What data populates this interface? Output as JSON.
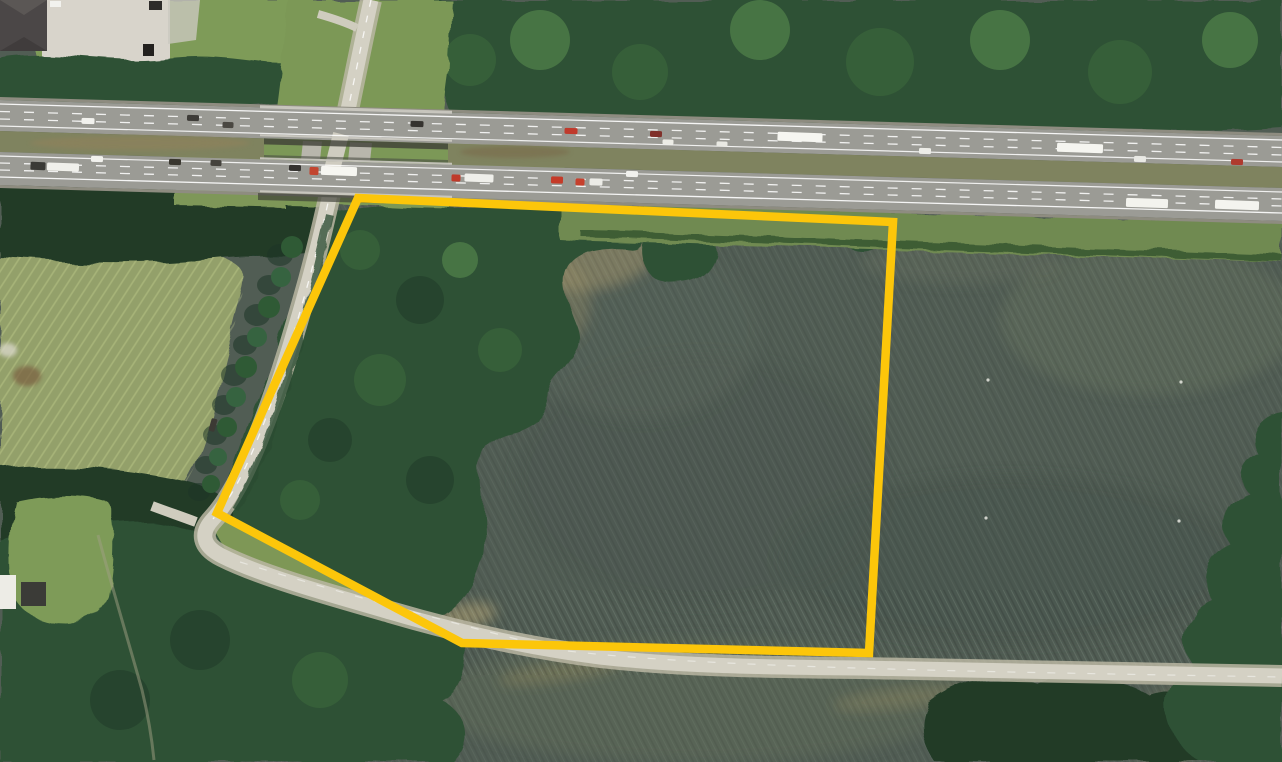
{
  "scene": {
    "type": "satellite-aerial-photo",
    "description": "Oblique aerial/satellite view of a land parcel outlined in yellow, bounded on the north by a divided interstate highway with an overpass interchange, on the west by a tree-lined local road descending from the overpass, and on the south by a rural road. Western half of the parcel is woodland, eastern half is open farm field. Surrounding farm fields, woods, a meadow, and a commercial building with parking lot at top left.",
    "visible_text": ""
  },
  "overlay": {
    "parcel_boundary": {
      "points": "358,198 893,222 869,653 462,643 217,513",
      "stroke_color": "#FCC60A",
      "stroke_width": 8.5
    }
  },
  "palette": {
    "field_dark": "#515D54",
    "field_mid": "#5A665A",
    "field_bottom": "#5D6857",
    "field_tan": "#A79A72",
    "meadow": "#93A06B",
    "lawn": "#7E9B58",
    "grass_verge": "#6F8A51",
    "embankment": "#7C9857",
    "tree_dark": "#203A28",
    "tree_mid": "#2E5134",
    "tree_light": "#3E6C3C",
    "tree_bright": "#5C9150",
    "scrub": "#33522F",
    "asphalt": "#9B9B95",
    "shoulder_gravel": "#8E8C80",
    "bridge_concrete": "#CDCBC3",
    "median_olive": "#7F835F",
    "median_brown": "#8F815C",
    "local_road": "#D4D1C4",
    "road_shoulder": "#BAB6A2",
    "parking": "#D8D4CB",
    "roof_dark": "#4B4747",
    "underpass_shadow": "#3E4037",
    "lane_marking": "#FFFFFF"
  },
  "vehicles": [
    {
      "cx": 88,
      "cy": 121,
      "w": 13,
      "h": 6,
      "fill": "#F2F2EE",
      "kind": "car"
    },
    {
      "cx": 193,
      "cy": 118,
      "w": 12,
      "h": 6,
      "fill": "#3E3C38",
      "kind": "car"
    },
    {
      "cx": 228,
      "cy": 125,
      "w": 11,
      "h": 6,
      "fill": "#4A4842",
      "kind": "car"
    },
    {
      "cx": 417,
      "cy": 124,
      "w": 13,
      "h": 6,
      "fill": "#35332F",
      "kind": "car"
    },
    {
      "cx": 571,
      "cy": 131,
      "w": 13,
      "h": 6,
      "fill": "#C03A2C",
      "kind": "car"
    },
    {
      "cx": 656,
      "cy": 134,
      "w": 12,
      "h": 6,
      "fill": "#80302A",
      "kind": "car"
    },
    {
      "cx": 668,
      "cy": 142,
      "w": 11,
      "h": 5,
      "fill": "#ECECE6",
      "kind": "car"
    },
    {
      "cx": 722,
      "cy": 144,
      "w": 11,
      "h": 5,
      "fill": "#E9E9E3",
      "kind": "car"
    },
    {
      "cx": 800,
      "cy": 137,
      "w": 45,
      "h": 9,
      "fill": "#F6F6F1",
      "kind": "truck"
    },
    {
      "cx": 925,
      "cy": 151,
      "w": 12,
      "h": 6,
      "fill": "#EDEDE8",
      "kind": "car"
    },
    {
      "cx": 1080,
      "cy": 148,
      "w": 46,
      "h": 9,
      "fill": "#F5F5F0",
      "kind": "truck"
    },
    {
      "cx": 1140,
      "cy": 159,
      "w": 12,
      "h": 6,
      "fill": "#E9E9E4",
      "kind": "car"
    },
    {
      "cx": 1237,
      "cy": 162,
      "w": 12,
      "h": 6,
      "fill": "#AF3A2E",
      "kind": "car"
    },
    {
      "cx": 38,
      "cy": 166,
      "w": 15,
      "h": 8,
      "fill": "#3A3A36",
      "kind": "truck"
    },
    {
      "cx": 63,
      "cy": 167,
      "w": 32,
      "h": 8,
      "fill": "#F0F0EB",
      "kind": "truck"
    },
    {
      "cx": 97,
      "cy": 159,
      "w": 12,
      "h": 6,
      "fill": "#F2F2EE",
      "kind": "car"
    },
    {
      "cx": 175,
      "cy": 162,
      "w": 12,
      "h": 6,
      "fill": "#39372F",
      "kind": "car"
    },
    {
      "cx": 216,
      "cy": 163,
      "w": 11,
      "h": 6,
      "fill": "#45433D",
      "kind": "car"
    },
    {
      "cx": 295,
      "cy": 168,
      "w": 12,
      "h": 6,
      "fill": "#353330",
      "kind": "car"
    },
    {
      "cx": 314,
      "cy": 171,
      "w": 9,
      "h": 8,
      "fill": "#C2452F",
      "kind": "truck"
    },
    {
      "cx": 339,
      "cy": 171,
      "w": 36,
      "h": 9,
      "fill": "#F6F6F1",
      "kind": "truck"
    },
    {
      "cx": 456,
      "cy": 178,
      "w": 9,
      "h": 7,
      "fill": "#BF3A2A",
      "kind": "truck"
    },
    {
      "cx": 479,
      "cy": 178,
      "w": 29,
      "h": 8,
      "fill": "#EFEFEA",
      "kind": "truck"
    },
    {
      "cx": 557,
      "cy": 180,
      "w": 12,
      "h": 7,
      "fill": "#C53B28",
      "kind": "car"
    },
    {
      "cx": 580,
      "cy": 182,
      "w": 9,
      "h": 7,
      "fill": "#C6402D",
      "kind": "truck"
    },
    {
      "cx": 596,
      "cy": 182,
      "w": 13,
      "h": 7,
      "fill": "#ECECE7",
      "kind": "truck"
    },
    {
      "cx": 632,
      "cy": 174,
      "w": 12,
      "h": 6,
      "fill": "#F1F1ED",
      "kind": "car"
    },
    {
      "cx": 1147,
      "cy": 203,
      "w": 42,
      "h": 9,
      "fill": "#F3F3EE",
      "kind": "truck"
    },
    {
      "cx": 1237,
      "cy": 205,
      "w": 44,
      "h": 9,
      "fill": "#F4F4EF",
      "kind": "truck"
    },
    {
      "cx": 213,
      "cy": 425,
      "w": 6,
      "h": 13,
      "fill": "#3C3A34",
      "kind": "car",
      "rot": 16
    }
  ],
  "field_specks": [
    [
      988,
      380
    ],
    [
      1181,
      382
    ],
    [
      986,
      518
    ],
    [
      1179,
      521
    ]
  ]
}
